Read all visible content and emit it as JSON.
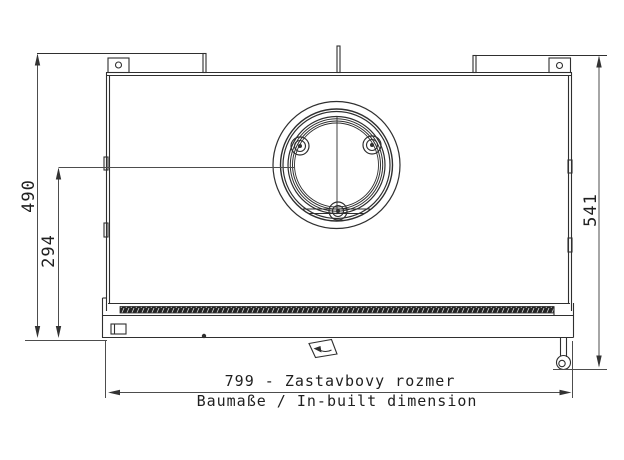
{
  "drawing": {
    "type": "technical-dimension-drawing",
    "subject": "appliance rear view with flue outlet",
    "dimensions": {
      "left_overall_height": "490",
      "left_flue_center_height": "294",
      "right_overall_height": "541",
      "bottom_width_primary": "799 - Zastavbovy rozmer",
      "bottom_width_secondary": "Baumaße / In-built dimension"
    },
    "colors": {
      "background": "#ffffff",
      "object_line": "#2f2f2f",
      "dimension_line": "#4d4d4d",
      "text": "#1f1f1f"
    }
  }
}
